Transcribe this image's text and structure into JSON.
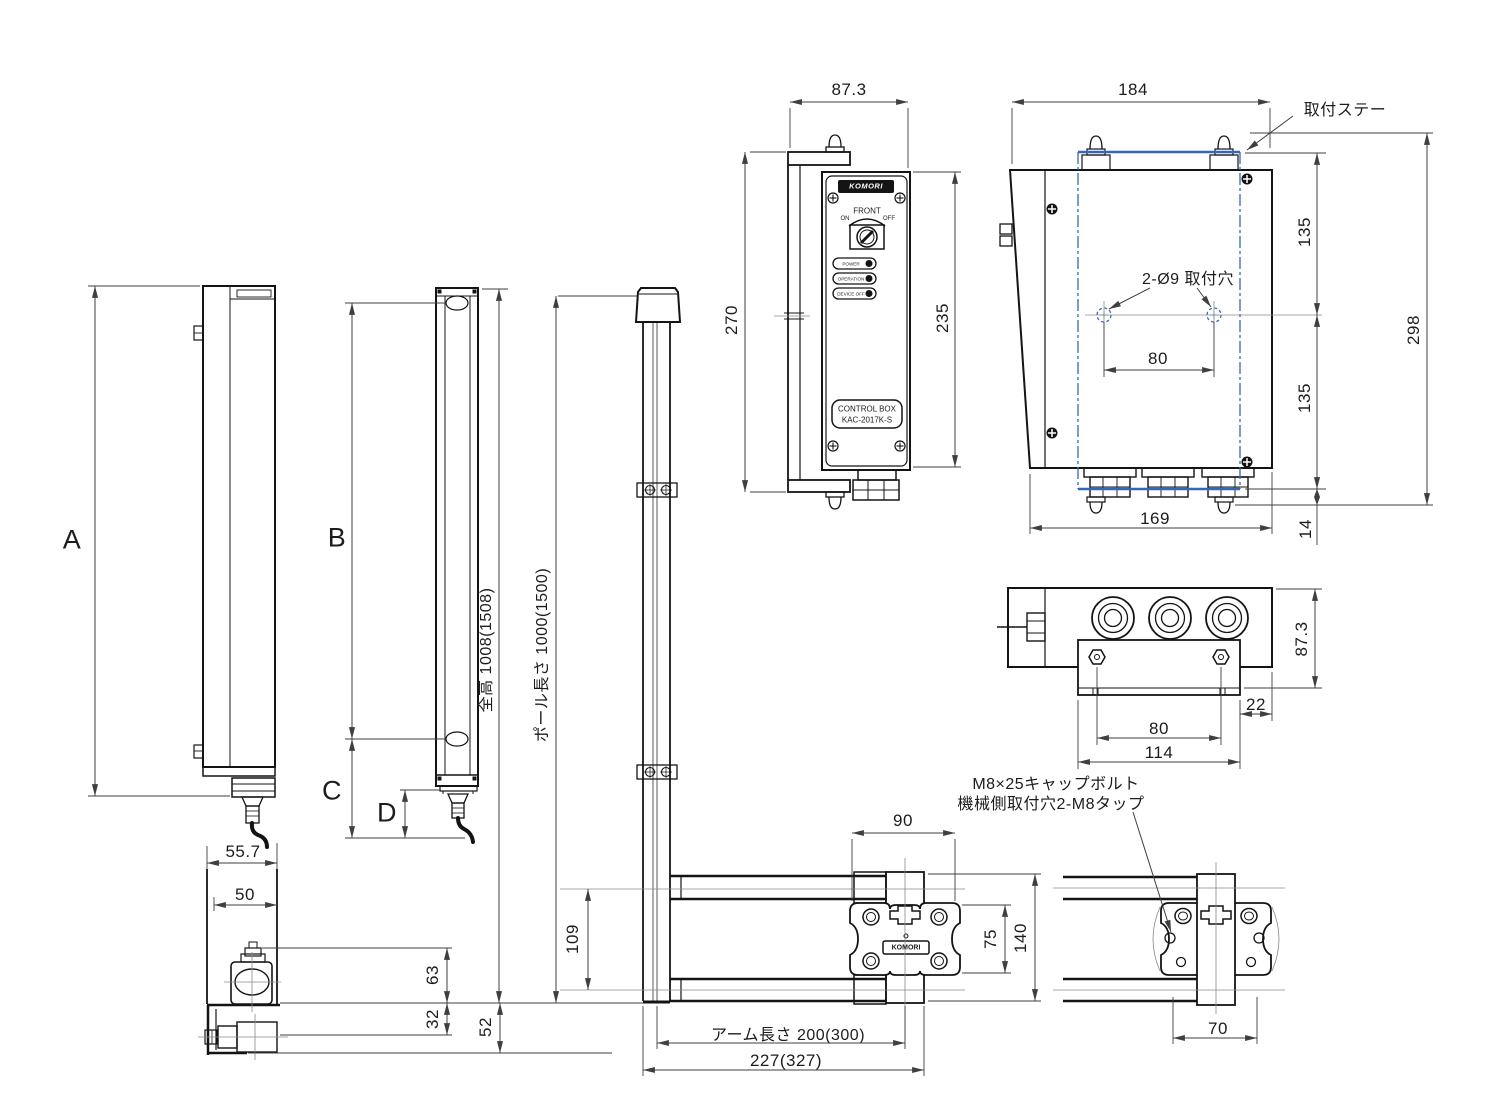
{
  "colors": {
    "line": "#141414",
    "dimension": "#3f3f3f",
    "accent_blue": "#3566b8",
    "centerline": "#8a8a8a",
    "background": "#ffffff"
  },
  "view_labels": {
    "a": "A",
    "b": "B",
    "c": "C",
    "d": "D"
  },
  "dimensions": {
    "overall_height": "全高 1008(1508)",
    "pole_length": "ポール長さ 1000(1500)",
    "arm_length": "アーム長さ 200(300)",
    "arm_overall": "227(327)",
    "sensor_width": "55.7",
    "sensor_face_width": "50",
    "mount_63": "63",
    "mount_32": "32",
    "mount_52": "52",
    "box_width": "87.3",
    "box_bracket_height": "270",
    "box_height": "235",
    "rear_width": "184",
    "rear_135_upper": "135",
    "rear_135_lower": "135",
    "rear_height": "298",
    "hole_pitch": "80",
    "rear_base_width": "169",
    "rear_offset": "14",
    "bottom_depth": "87.3",
    "bottom_22": "22",
    "bottom_hole_pitch": "80",
    "bottom_plate_width": "114",
    "arm_pitch": "109",
    "bracket_width_90": "90",
    "bracket_75": "75",
    "bracket_140": "140",
    "machine_hole_pitch": "70"
  },
  "callouts": {
    "mounting_stay": "取付ステー",
    "mounting_holes": "2-Ø9 取付穴",
    "cap_bolt": "M8×25キャップボルト",
    "machine_side_tap": "機械側取付穴2-M8タップ"
  },
  "control_box": {
    "logo": "KOMORI",
    "panel_label": "FRONT",
    "switch_on": "ON",
    "switch_off": "OFF",
    "leds": [
      "POWER",
      "OPERATION",
      "DEVICE OFF"
    ],
    "name_line1": "CONTROL BOX",
    "name_line2": "KAC-2017K-S"
  },
  "arm_bracket": {
    "logo": "KOMORI"
  }
}
